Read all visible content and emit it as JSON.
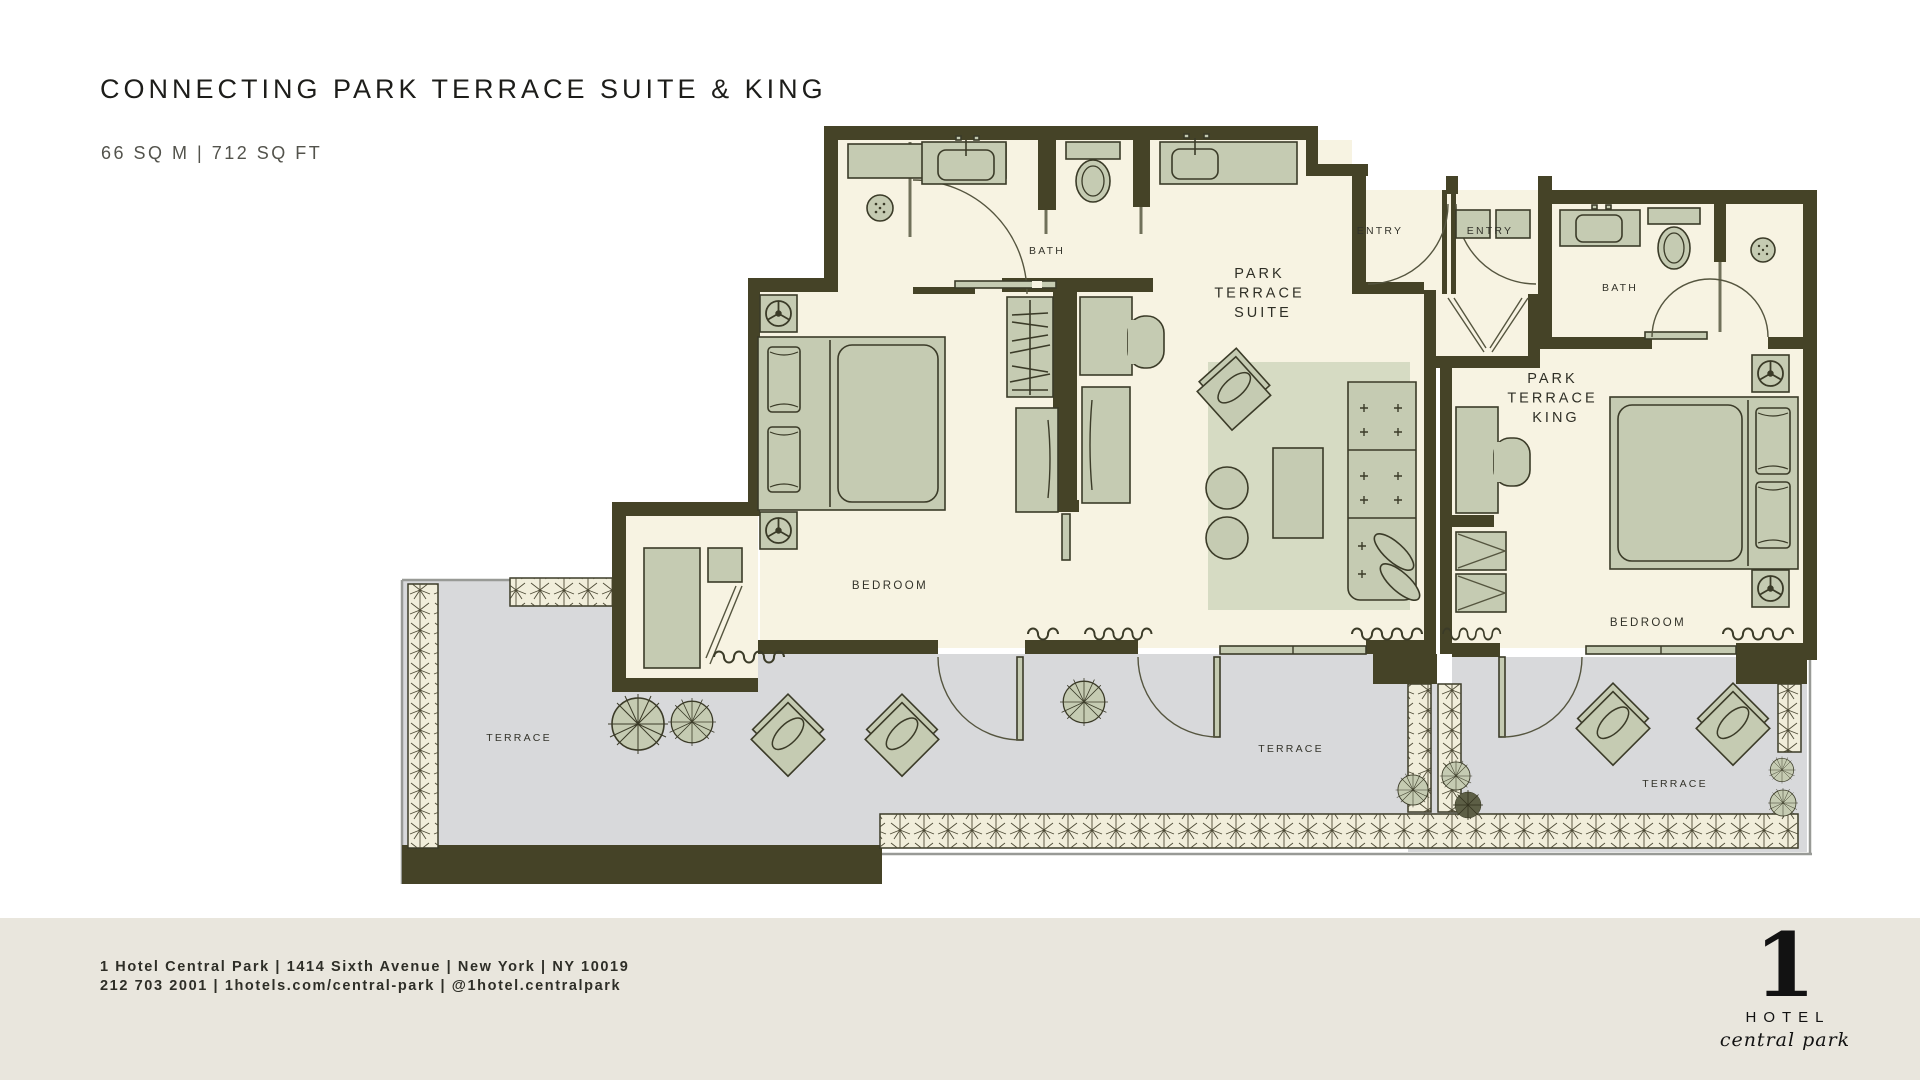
{
  "header": {
    "title": "CONNECTING PARK TERRACE SUITE & KING",
    "area": "66 SQ M | 712 SQ FT"
  },
  "plan": {
    "labels": {
      "bath_left": "BATH",
      "bath_right": "BATH",
      "entry_left": "ENTRY",
      "entry_right": "ENTRY",
      "suite": [
        "PARK",
        "TERRACE",
        "SUITE"
      ],
      "king": [
        "PARK",
        "TERRACE",
        "KING"
      ],
      "bedroom_left": "BEDROOM",
      "bedroom_right": "BEDROOM",
      "terrace_left": "TERRACE",
      "terrace_middle": "TERRACE",
      "terrace_right": "TERRACE"
    },
    "colors": {
      "wall": "#454327",
      "floor": "#f7f3e2",
      "terrace": "#d8d9db",
      "furniture": "#c5cbb2",
      "rug": "#d6dbc3",
      "footer_band": "#e9e6dd"
    }
  },
  "footer": {
    "line1": "1 Hotel Central Park | 1414 Sixth Avenue | New York | NY 10019",
    "line2": "212 703 2001 | 1hotels.com/central-park | @1hotel.centralpark"
  },
  "logo": {
    "numeral": "1",
    "hotel": "HOTEL",
    "script": "central park"
  }
}
